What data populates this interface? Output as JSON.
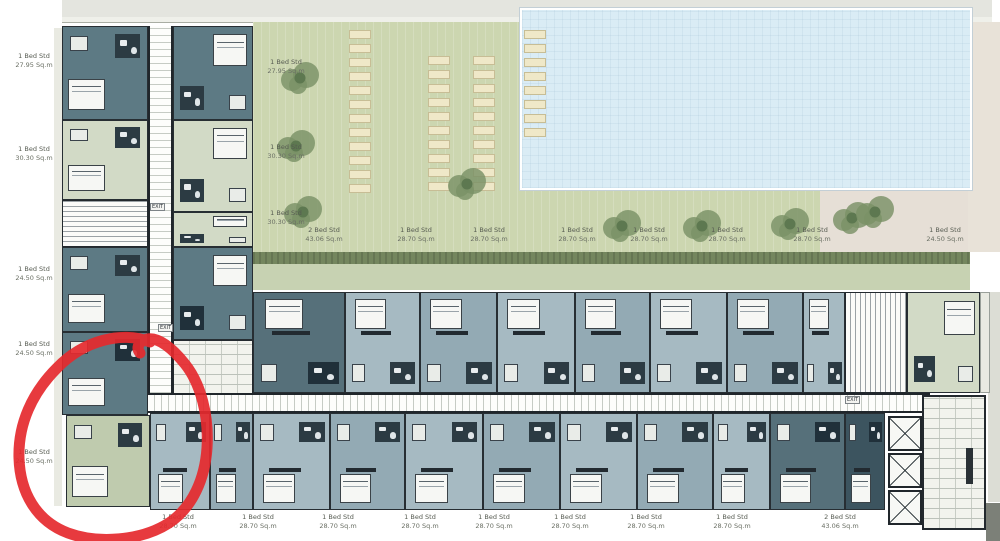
{
  "colors": {
    "wall": "#252b30",
    "teal_unit": "#5d7a84",
    "teal_dark_unit": "#56707a",
    "bluegray_unit": "#a6bac2",
    "bluegray_unit_2": "#93aab4",
    "sage_unit": "#d2dac6",
    "sage_unit_dark": "#bfcbae",
    "navy_unit": "#3c545f",
    "lawn": "#ccd6b0",
    "hedge": "#74865e",
    "verge": "#c7d2b2",
    "pool": "#daecf5",
    "paving": "#e8e2d8",
    "walkway": "#e4e5df",
    "lounger": "#efe8c8",
    "annotation_red": "#e5292e"
  },
  "labels": {
    "left_column": [
      {
        "name": "1 Bed Std",
        "area": "27.95 Sq.m"
      },
      {
        "name": "1 Bed Std",
        "area": "30.30 Sq.m"
      },
      {
        "name": "1 Bed Std",
        "area": "24.50 Sq.m"
      },
      {
        "name": "1 Bed Std",
        "area": "24.50 Sq.m"
      },
      {
        "name": "1 Bed Std",
        "area": "24.50 Sq.m"
      }
    ],
    "inner_column": [
      {
        "name": "1 Bed Std",
        "area": "27.95 Sq.m"
      },
      {
        "name": "1 Bed Std",
        "area": "30.30 Sq.m"
      },
      {
        "name": "1 Bed Std",
        "area": "30.30 Sq.m"
      }
    ],
    "middle_row": [
      {
        "name": "2 Bed Std",
        "area": "43.06 Sq.m"
      },
      {
        "name": "1 Bed Std",
        "area": "28.70 Sq.m"
      },
      {
        "name": "1 Bed Std",
        "area": "28.70 Sq.m"
      },
      {
        "name": "1 Bed Std",
        "area": "28.70 Sq.m"
      },
      {
        "name": "1 Bed Std",
        "area": "28.70 Sq.m"
      },
      {
        "name": "1 Bed Std",
        "area": "28.70 Sq.m"
      },
      {
        "name": "1 Bed Std",
        "area": "28.70 Sq.m"
      },
      {
        "name": "1 Bed Std",
        "area": "24.50 Sq.m"
      }
    ],
    "bottom_row": [
      {
        "name": "1 Bed Std",
        "area": "28.70 Sq.m"
      },
      {
        "name": "1 Bed Std",
        "area": "28.70 Sq.m"
      },
      {
        "name": "1 Bed Std",
        "area": "28.70 Sq.m"
      },
      {
        "name": "1 Bed Std",
        "area": "28.70 Sq.m"
      },
      {
        "name": "1 Bed Std",
        "area": "28.70 Sq.m"
      },
      {
        "name": "1 Bed Std",
        "area": "28.70 Sq.m"
      },
      {
        "name": "1 Bed Std",
        "area": "28.70 Sq.m"
      },
      {
        "name": "1 Bed Std",
        "area": "28.70 Sq.m"
      },
      {
        "name": "2 Bed Std",
        "area": "43.06 Sq.m"
      }
    ],
    "exit": "EXIT"
  },
  "annotation": {
    "type": "hand-drawn red circle",
    "color": "#e5292e",
    "highlights": "lower-left corner unit of the plan"
  }
}
